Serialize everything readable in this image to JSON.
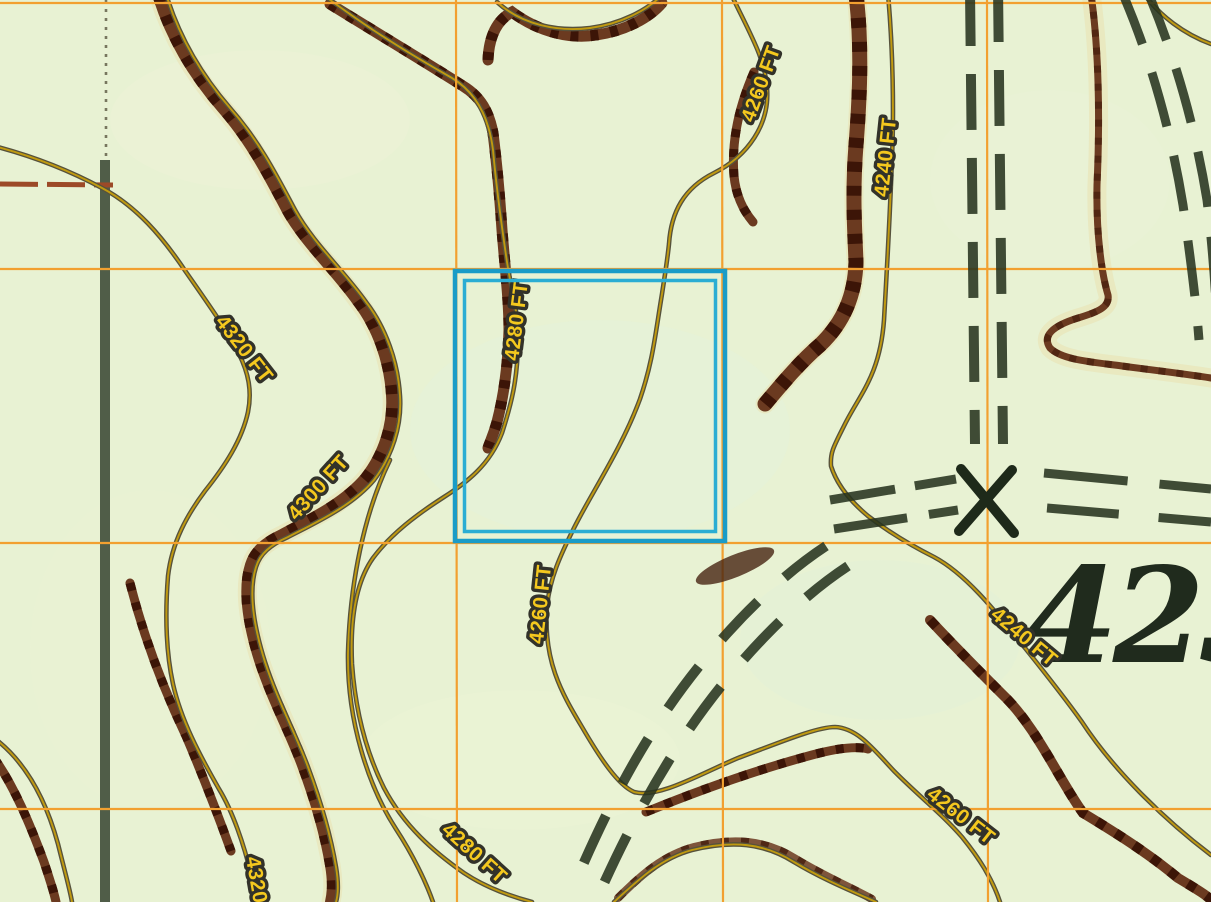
{
  "map": {
    "title": "Topographic map tile with contour lines, UTM grid and selection box",
    "background_color": "#e8f2d3",
    "grid": {
      "color": "#f2a030",
      "vertical_lines_x": [
        456,
        722,
        987
      ],
      "horizontal_lines_y": [
        3,
        269,
        543,
        809
      ]
    },
    "selection_box": {
      "x": 455,
      "y": 271,
      "width": 270,
      "height": 270,
      "color": "#1a9cc7",
      "style": "double-line"
    },
    "contour_labels": [
      {
        "text": "4320 FT",
        "elevation_ft": 4320
      },
      {
        "text": "4300 FT",
        "elevation_ft": 4300
      },
      {
        "text": "4280 FT",
        "elevation_ft": 4280
      },
      {
        "text": "4260 FT",
        "elevation_ft": 4260
      },
      {
        "text": "4240 FT",
        "elevation_ft": 4240
      },
      {
        "text": "4260 FT",
        "elevation_ft": 4260
      },
      {
        "text": "4240 FT",
        "elevation_ft": 4240
      },
      {
        "text": "4260 FT",
        "elevation_ft": 4260
      },
      {
        "text": "4280 FT",
        "elevation_ft": 4280
      },
      {
        "text": "4320",
        "elevation_ft": 4320
      }
    ],
    "spot_elevation": {
      "text": "423"
    },
    "colors": {
      "contour_thin_gold": "#c09a10",
      "contour_casing": "#56523c",
      "contour_index_brown": "#6b3a20",
      "trail_dashes_dark": "#27331f",
      "section_line": "#42503c",
      "section_line_red_tick": "#9c4a28",
      "label_yellow": "#f4c81e",
      "label_outline": "#32322a",
      "spot_elevation_text": "#202b1d"
    },
    "symbols": [
      {
        "name": "x-marker",
        "meaning": "trail crossing / mine-style X symbol"
      },
      {
        "name": "dashed-double-track-vertical",
        "meaning": "unimproved road (two dashed lines)"
      },
      {
        "name": "dashed-double-track-horizontal",
        "meaning": "unimproved road (two dashed lines)"
      },
      {
        "name": "dashed-double-track-diagonal-sw",
        "meaning": "unimproved road (two dashed lines)"
      },
      {
        "name": "dashed-double-track-diagonal-ne",
        "meaning": "unimproved road (two dashed lines)"
      },
      {
        "name": "section-line-vertical",
        "meaning": "dark section/boundary line, dotted at top"
      }
    ]
  }
}
